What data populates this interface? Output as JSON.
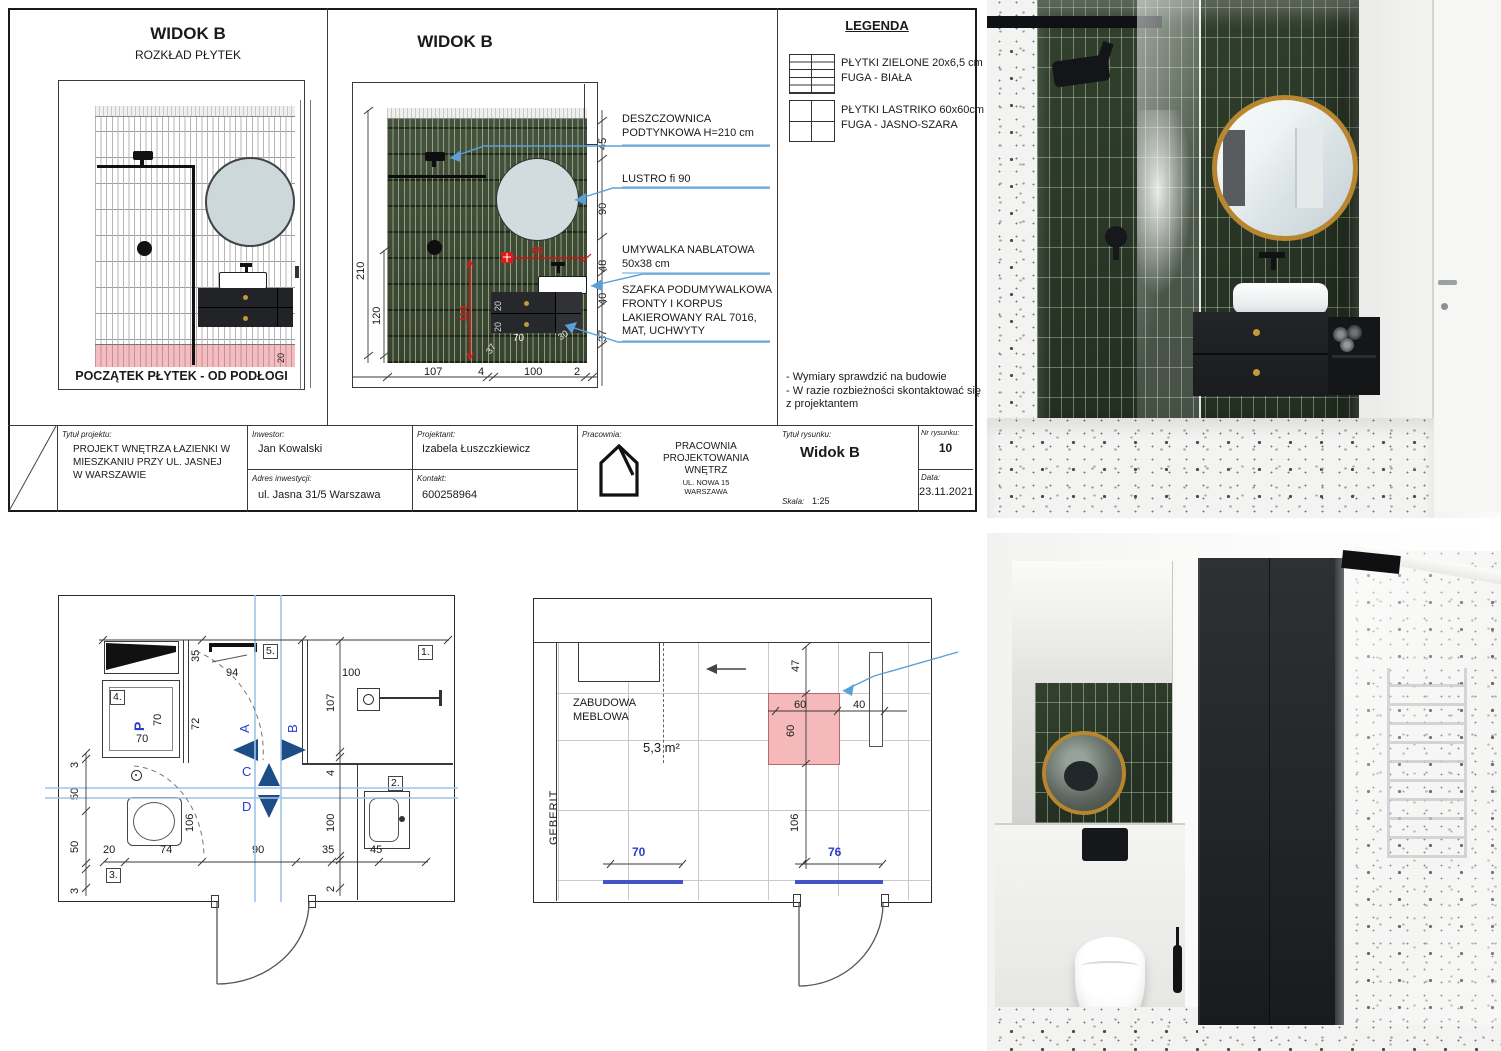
{
  "sheet": {
    "panel1": {
      "title": "WIDOK B",
      "subtitle": "ROZKŁAD PŁYTEK",
      "footer_note": "POCZĄTEK PŁYTEK - OD PODŁOGI",
      "tile_offset_dim": "20"
    },
    "panel2": {
      "title": "WIDOK B",
      "dims_left": [
        "210",
        "120"
      ],
      "dims_bottom": [
        "107",
        "4",
        "100",
        "2"
      ],
      "dims_right": [
        "45",
        "90",
        "48",
        "40",
        "37"
      ],
      "dims_cabinet": [
        "20",
        "20",
        "70",
        "30",
        "37"
      ],
      "dims_red": [
        "85",
        "110"
      ]
    },
    "annotations": [
      [
        "DESZCZOWNICA",
        "PODTYNKOWA H=210 cm"
      ],
      [
        "LUSTRO fi 90"
      ],
      [
        "UMYWALKA NABLATOWA",
        "50x38 cm"
      ],
      [
        "SZAFKA PODUMYWALKOWA",
        "FRONTY I KORPUS",
        "LAKIEROWANY RAL 7016,",
        "MAT, UCHWYTY"
      ]
    ],
    "legend": {
      "title": "LEGENDA",
      "items": [
        {
          "line1": "PŁYTKI ZIELONE 20x6,5 cm",
          "line2": "FUGA - BIAŁA"
        },
        {
          "line1": "PŁYTKI LASTRIKO 60x60cm",
          "line2": "FUGA - JASNO-SZARA"
        }
      ],
      "notes": [
        "- Wymiary sprawdzić na budowie",
        "- W razie rozbieżności skontaktować się",
        "z projektantem"
      ]
    },
    "titleblock": {
      "project_label": "Tytuł projektu:",
      "project_lines": [
        "PROJEKT WNĘTRZA ŁAZIENKI W",
        "MIESZKANIU PRZY UL. JASNEJ",
        "W WARSZAWIE"
      ],
      "investor_label": "Inwestor:",
      "investor": "Jan Kowalski",
      "address_label": "Adres inwestycji:",
      "address": "ul. Jasna 31/5 Warszawa",
      "designer_label": "Projektant:",
      "designer": "Izabela Łuszczkiewicz",
      "contact_label": "Kontakt:",
      "contact": "600258964",
      "studio_label": "Pracownia:",
      "studio_lines": [
        "PRACOWNIA",
        "PROJEKTOWANIA",
        "WNĘTRZ"
      ],
      "studio_address": [
        "UL. NOWA 15",
        "WARSZAWA"
      ],
      "drawing_title_label": "Tytuł rysunku:",
      "drawing_title": "Widok B",
      "scale_label": "Skala:",
      "scale": "1:25",
      "number_label": "Nr rysunku:",
      "number": "10",
      "date_label": "Data:",
      "date": "23.11.2021"
    }
  },
  "plan1": {
    "marks": [
      "1.",
      "2.",
      "3.",
      "4.",
      "5."
    ],
    "letters": {
      "p": "P",
      "a": "A",
      "b": "B",
      "c": "C",
      "d": "D"
    },
    "dims": {
      "top": [
        "35",
        "94",
        "100"
      ],
      "left": [
        "70",
        "70",
        "72"
      ],
      "right": [
        "107",
        "4",
        "100",
        "2"
      ],
      "chain_left": [
        "3",
        "50",
        "50",
        "3"
      ],
      "bottom": [
        "20",
        "74",
        "90",
        "35",
        "45"
      ],
      "wc": "106"
    }
  },
  "plan2": {
    "room_label_lines": [
      "ZABUDOWA",
      "MEBLOWA"
    ],
    "area": "5,3 m²",
    "geberit": "GEBERIT",
    "dims": [
      "47",
      "60",
      "60",
      "40",
      "106"
    ],
    "blue_dims": [
      "70",
      "76"
    ]
  },
  "colors": {
    "tile_green": "#33402e",
    "grout_light": "#9aa795",
    "pink_highlight": "#f5b9bb",
    "leader_blue": "#5aa0d8",
    "section_navy": "#1d4d86",
    "text_blue": "#2b3ccc",
    "dim_red": "#e01818",
    "gold": "#c2993d"
  }
}
